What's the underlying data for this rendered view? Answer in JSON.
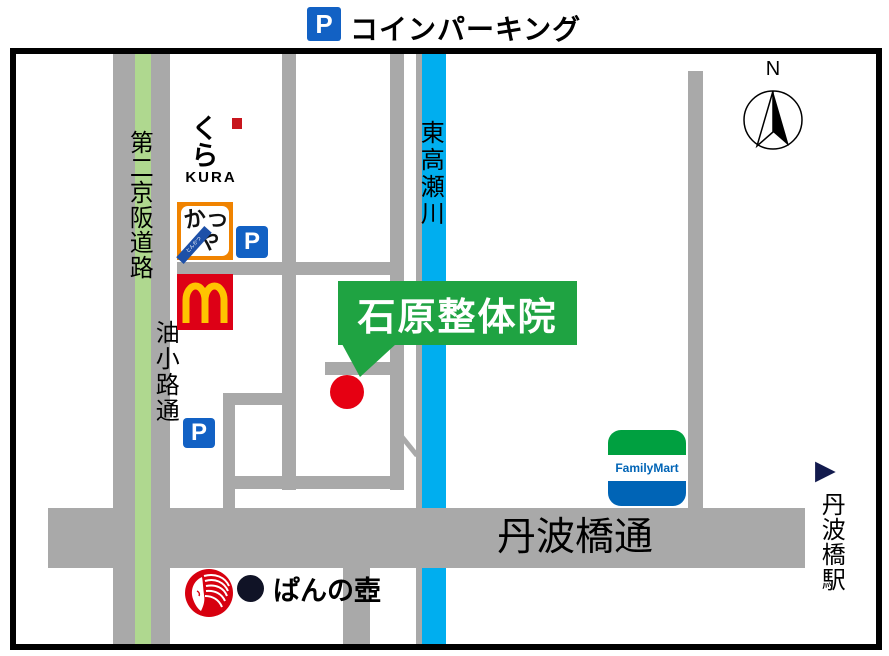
{
  "legend": {
    "p_icon": "P",
    "label": "コインパーキング"
  },
  "callout": {
    "label": "石原整体院"
  },
  "roads": {
    "daini_keihan": "第二京阪道路",
    "aburakoji": "油小路通",
    "higashi_takase_river": "東高瀬川",
    "tanbabashi_dori": "丹波橋通"
  },
  "station": {
    "arrow": "▶",
    "label": "丹波橋駅"
  },
  "compass": {
    "label": "N"
  },
  "parking": {
    "sign": "P"
  },
  "landmarks": {
    "kura": {
      "jp": "くら",
      "en": "KURA"
    },
    "katsuya": {
      "ka": "か",
      "tsu": "つ",
      "ya": "や",
      "ribbon": "とんかつ"
    },
    "familymart": {
      "label": "FamilyMart"
    },
    "bakery": {
      "label": "ぱんの壺"
    }
  },
  "colors": {
    "road_gray": "#A9A9A9",
    "river_blue": "#00AEEF",
    "highway_stripe_green": "#AFD88F",
    "callout_green": "#1FA342",
    "marker_red": "#E60012",
    "parking_blue": "#1261C4",
    "katsuya_orange": "#F08300",
    "mcdonalds_red": "#DD0016",
    "mcdonalds_yellow": "#FFC400",
    "familymart_green": "#00A040",
    "familymart_blue": "#0064B6",
    "bakery_red": "#D7000F"
  }
}
